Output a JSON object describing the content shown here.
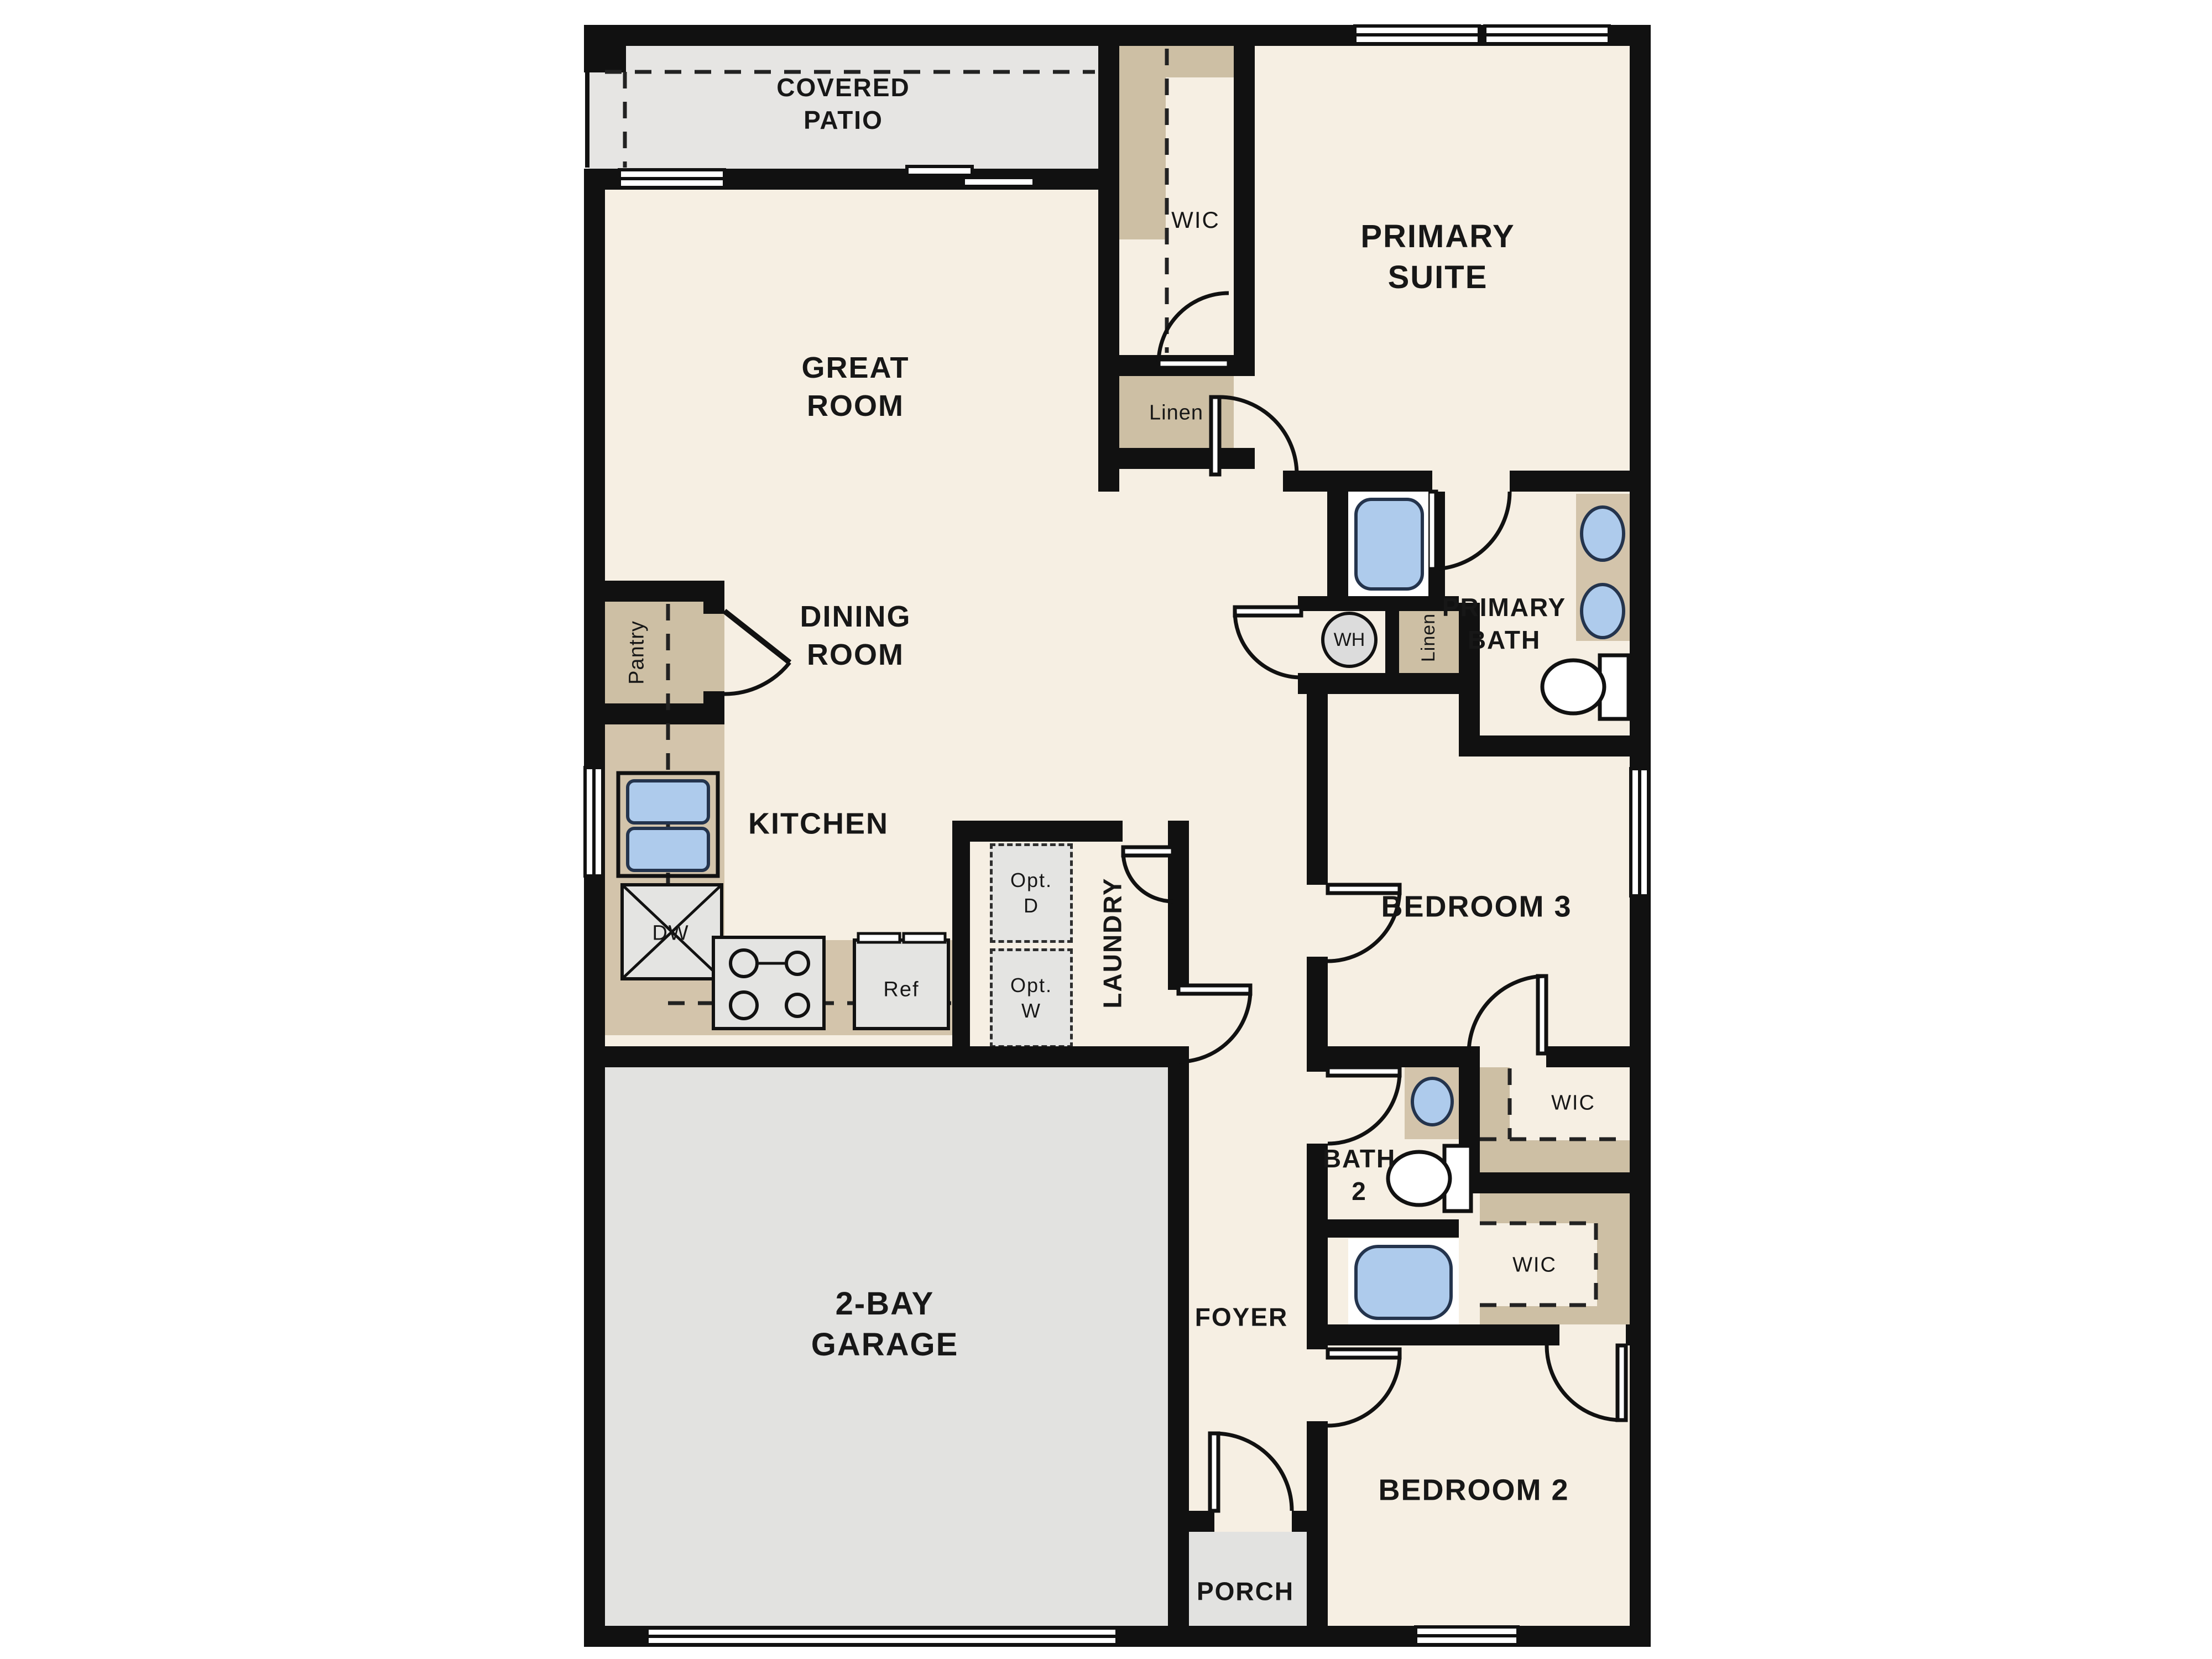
{
  "title": "Single-story floor plan",
  "labels": {
    "covered_patio": {
      "l1": "COVERED",
      "l2": "PATIO"
    },
    "great_room": {
      "l1": "GREAT",
      "l2": "ROOM"
    },
    "dining_room": {
      "l1": "DINING",
      "l2": "ROOM"
    },
    "kitchen": "KITCHEN",
    "pantry": "Pantry",
    "dw": "DW",
    "ref": "Ref",
    "opt_d": {
      "l1": "Opt.",
      "l2": "D"
    },
    "opt_w": {
      "l1": "Opt.",
      "l2": "W"
    },
    "laundry": "LAUNDRY",
    "wic_primary": "WIC",
    "linen_primary": "Linen",
    "primary_suite": {
      "l1": "PRIMARY",
      "l2": "SUITE"
    },
    "primary_bath": {
      "l1": "PRIMARY",
      "l2": "BATH"
    },
    "wh": "WH",
    "linen_hall": "Linen",
    "bedroom3": "BEDROOM 3",
    "wic_bed3": "WIC",
    "bath2": {
      "l1": "BATH",
      "l2": "2"
    },
    "wic_bed2": "WIC",
    "foyer": "FOYER",
    "bedroom2": "BEDROOM 2",
    "garage": {
      "l1": "2-BAY",
      "l2": "GARAGE"
    },
    "porch": "PORCH"
  },
  "colors": {
    "wall": "#111111",
    "floor": "#f6efe3",
    "patio": "#e6e5e3",
    "garage": "#e2e2e0",
    "porch": "#e2e2e0",
    "cabinet": "#d3c4ab",
    "closet_shelf": "#cdbfa4",
    "fixture_blue": "#aecbec",
    "fixture_outline": "#24344d",
    "appliance_gray": "#e4e4e2",
    "water_heater": "#dcdcdc"
  }
}
